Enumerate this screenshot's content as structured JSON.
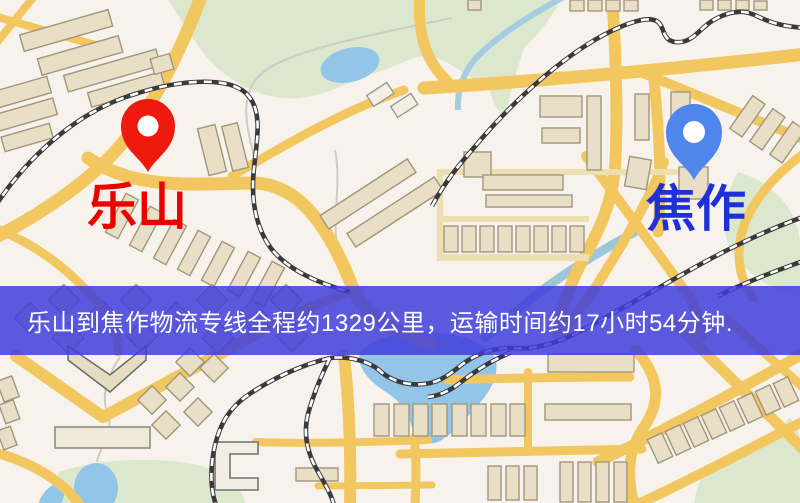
{
  "map": {
    "origin": {
      "label": "乐山",
      "pin_color": "#ee1a0e",
      "label_color": "#ed0000"
    },
    "destination": {
      "label": "焦作",
      "pin_color": "#4f86ec",
      "label_color": "#2030d8"
    },
    "banner": {
      "text": "乐山到焦作物流专线全程约1329公里，运输时间约17小时54分钟.",
      "bg_color": "rgba(64,61,219,0.85)",
      "text_color": "#ffffff"
    },
    "colors": {
      "background": "#f7f3ec",
      "road": "#f2c75f",
      "building": "#e9dfc6",
      "park": "#dce8cd",
      "water": "#93c5e8",
      "railway": "#3a3a3a"
    }
  }
}
